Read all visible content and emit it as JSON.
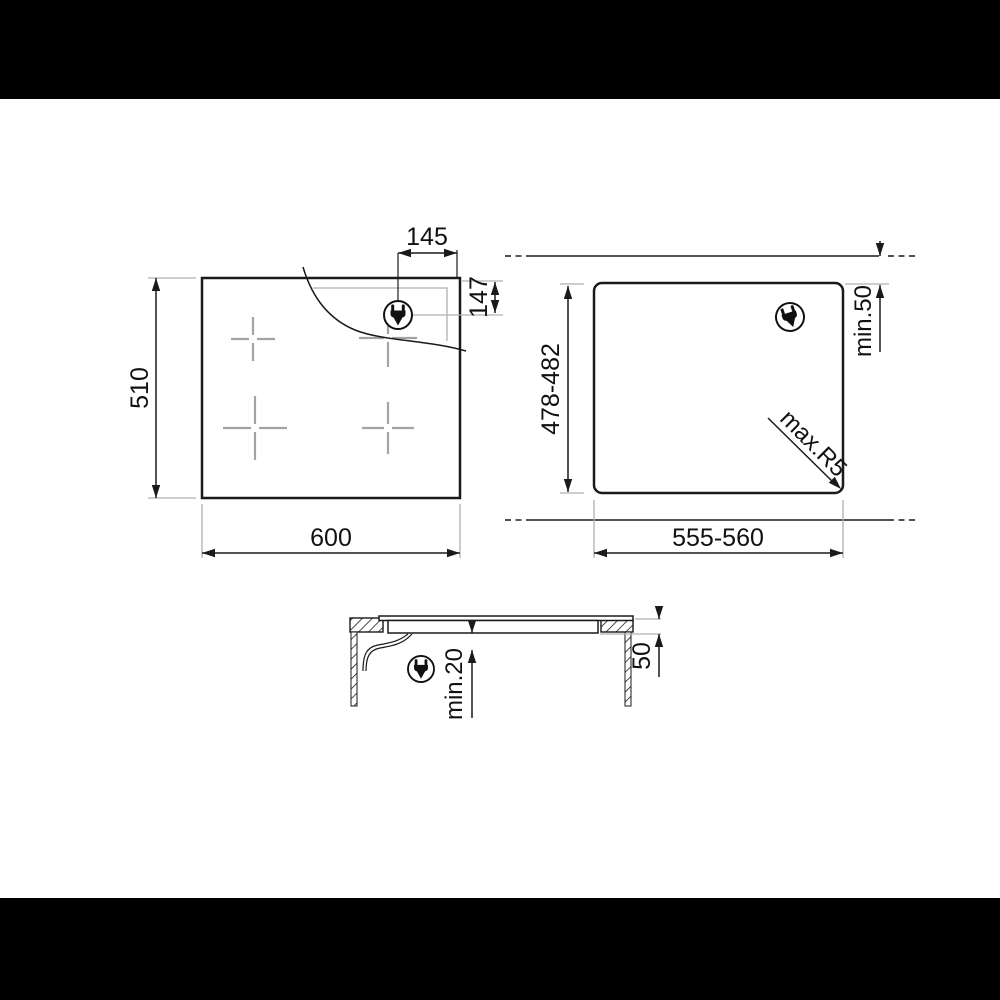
{
  "colors": {
    "background": "#ffffff",
    "letterbox": "#000000",
    "line_ink": "#1a1a1a",
    "extension_gray": "#b0b0b0",
    "cross_gray": "#a3a3a3"
  },
  "icons": {
    "power_plug": "power-plug-icon"
  },
  "top_view": {
    "width": "600",
    "height": "510",
    "plug_x": "145",
    "plug_y": "147"
  },
  "cutout_view": {
    "width": "555-560",
    "height": "478-482",
    "rear_clearance": "min.50",
    "corner_radius": "max.R5"
  },
  "section_view": {
    "clearance_below": "min.20",
    "depth": "50"
  }
}
